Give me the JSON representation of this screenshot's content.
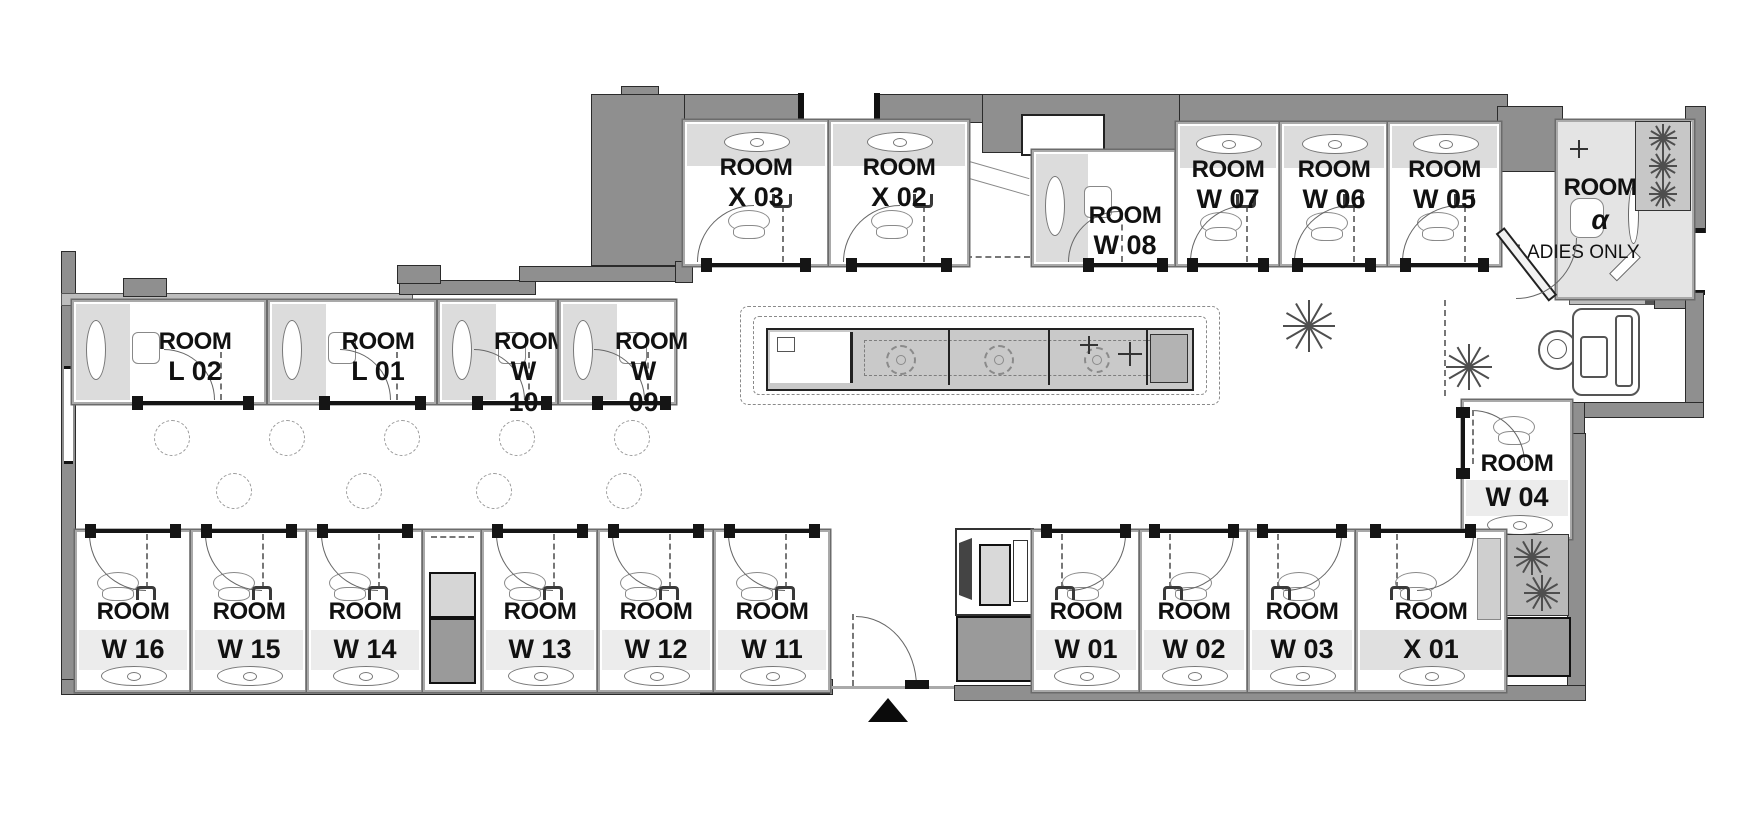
{
  "plan": {
    "title": "capsule-office floor plan",
    "labels": {
      "ladies_only": "LADIES ONLY"
    },
    "rooms": {
      "x03": {
        "name": "ROOM",
        "num": "X 03"
      },
      "x02": {
        "name": "ROOM",
        "num": "X 02"
      },
      "w08": {
        "name": "ROOM",
        "num": "W 08"
      },
      "w07": {
        "name": "ROOM",
        "num": "W 07"
      },
      "w06": {
        "name": "ROOM",
        "num": "W 06"
      },
      "w05": {
        "name": "ROOM",
        "num": "W 05"
      },
      "alpha": {
        "name": "ROOM",
        "num": "α",
        "note": "LADIES ONLY"
      },
      "l02": {
        "name": "ROOM",
        "num": "L 02"
      },
      "l01": {
        "name": "ROOM",
        "num": "L 01"
      },
      "w10": {
        "name": "ROOM",
        "num": "W 10"
      },
      "w09": {
        "name": "ROOM",
        "num": "W 09"
      },
      "w04": {
        "name": "ROOM",
        "num": "W 04"
      },
      "w16": {
        "name": "ROOM",
        "num": "W 16"
      },
      "w15": {
        "name": "ROOM",
        "num": "W 15"
      },
      "w14": {
        "name": "ROOM",
        "num": "W 14"
      },
      "w13": {
        "name": "ROOM",
        "num": "W 13"
      },
      "w12": {
        "name": "ROOM",
        "num": "W 12"
      },
      "w11": {
        "name": "ROOM",
        "num": "W 11"
      },
      "w01": {
        "name": "ROOM",
        "num": "W 01"
      },
      "w02": {
        "name": "ROOM",
        "num": "W 02"
      },
      "w03": {
        "name": "ROOM",
        "num": "W 03"
      },
      "x01": {
        "name": "ROOM",
        "num": "X 01"
      }
    },
    "icons": {
      "entrance": "entrance-arrow",
      "plant": "palm-plant",
      "table": "dashed-table-circle",
      "kitchen": "kitchen-counter",
      "massage_chair": "massage-chair",
      "door": "door-swing-arc"
    },
    "colors": {
      "wall": "#8f8f8f",
      "room_border": "#a9a9a9",
      "desk_band": "#dcdcdc",
      "number_band": "#ececec",
      "dark_box": "#9a9a9a",
      "ink": "#141414"
    }
  }
}
